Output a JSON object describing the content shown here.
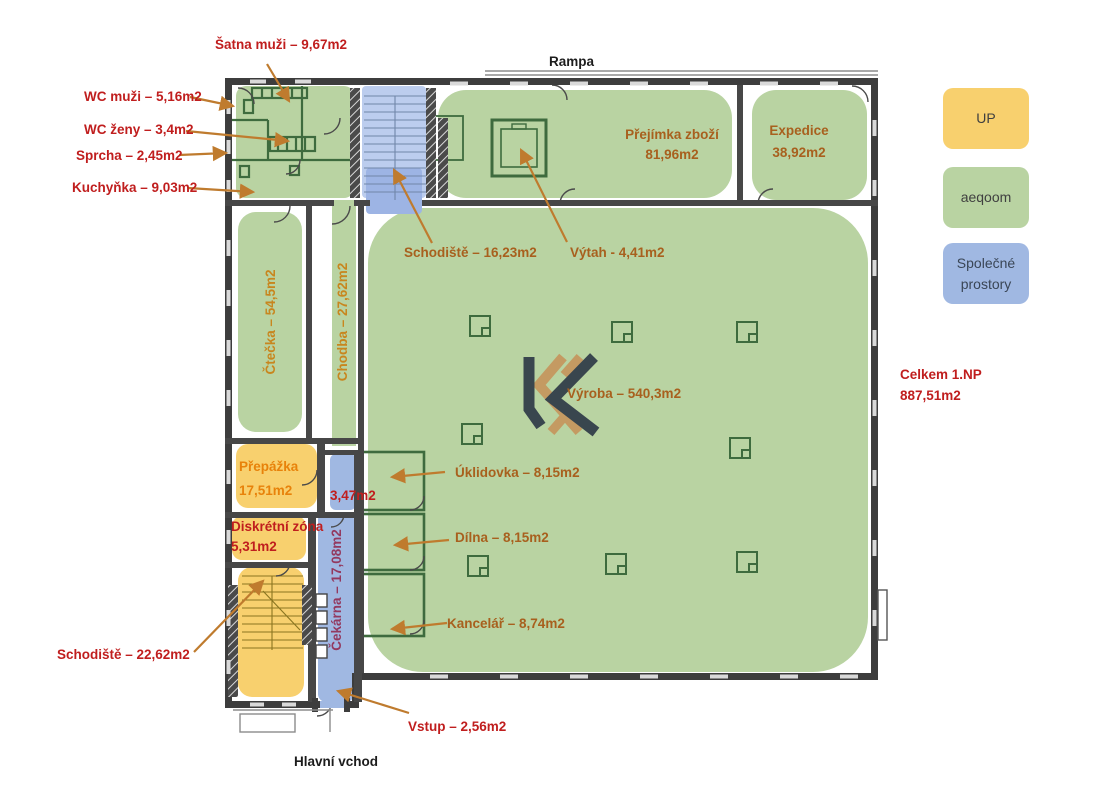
{
  "colors": {
    "zone_green": "#b9d3a2",
    "zone_yellow": "#f8d06e",
    "zone_blue": "#a0b8e2",
    "stair_blue": "#bccdee",
    "stair_blue_dark": "#9db4e4",
    "wall": "#3d3d3d",
    "inner_wall": "#474747",
    "room_line": "#3e6b3e",
    "arrow": "#bf7b2e",
    "label_red": "#c01e1e",
    "label_brown": "#a8601e",
    "label_gold": "#c8861e",
    "label_orange": "#e8820a",
    "label_maroon": "#93395f",
    "logo_dark": "#39464e",
    "logo_tan": "#c49a62"
  },
  "legend": {
    "items": [
      {
        "label": "UP",
        "color": "#f8d06e"
      },
      {
        "label": "aeqoom",
        "color": "#b9d3a2"
      },
      {
        "label": "Společné prostory",
        "color": "#a0b8e2"
      }
    ]
  },
  "labels": {
    "rampa": "Rampa",
    "hlavni_vchod": "Hlavní vchod",
    "celkem_line1": "Celkem 1.NP",
    "celkem_line2": "887,51m2",
    "satna": "Šatna muži – 9,67m2",
    "wc_muzi": "WC muži – 5,16m2",
    "wc_zeny": "WC ženy – 3,4m2",
    "sprcha": "Sprcha – 2,45m2",
    "kuchynka": "Kuchyňka – 9,03m2",
    "schodiste_top": "Schodiště – 16,23m2",
    "vytah": "Výtah - 4,41m2",
    "prejimka_name": "Přejímka zboží",
    "prejimka_area": "81,96m2",
    "expedice_name": "Expedice",
    "expedice_area": "38,92m2",
    "ctecka": "Čtečka – 54,5m2",
    "chodba": "Chodba – 27,62m2",
    "vyroba": "Výroba – 540,3m2",
    "uklidovka": "Úklidovka – 8,15m2",
    "dilna": "Dílna – 8,15m2",
    "kancelar": "Kancelář – 8,74m2",
    "prepazka_name": "Přepážka",
    "prepazka_area": "17,51m2",
    "mala_mistnost": "3,47m2",
    "diskretni_name": "Diskrétní zóna",
    "diskretni_area": "5,31m2",
    "cekarna": "Čekárna – 17,08m2",
    "schodiste_bottom": "Schodiště – 22,62m2",
    "vstup": "Vstup – 2,56m2"
  }
}
